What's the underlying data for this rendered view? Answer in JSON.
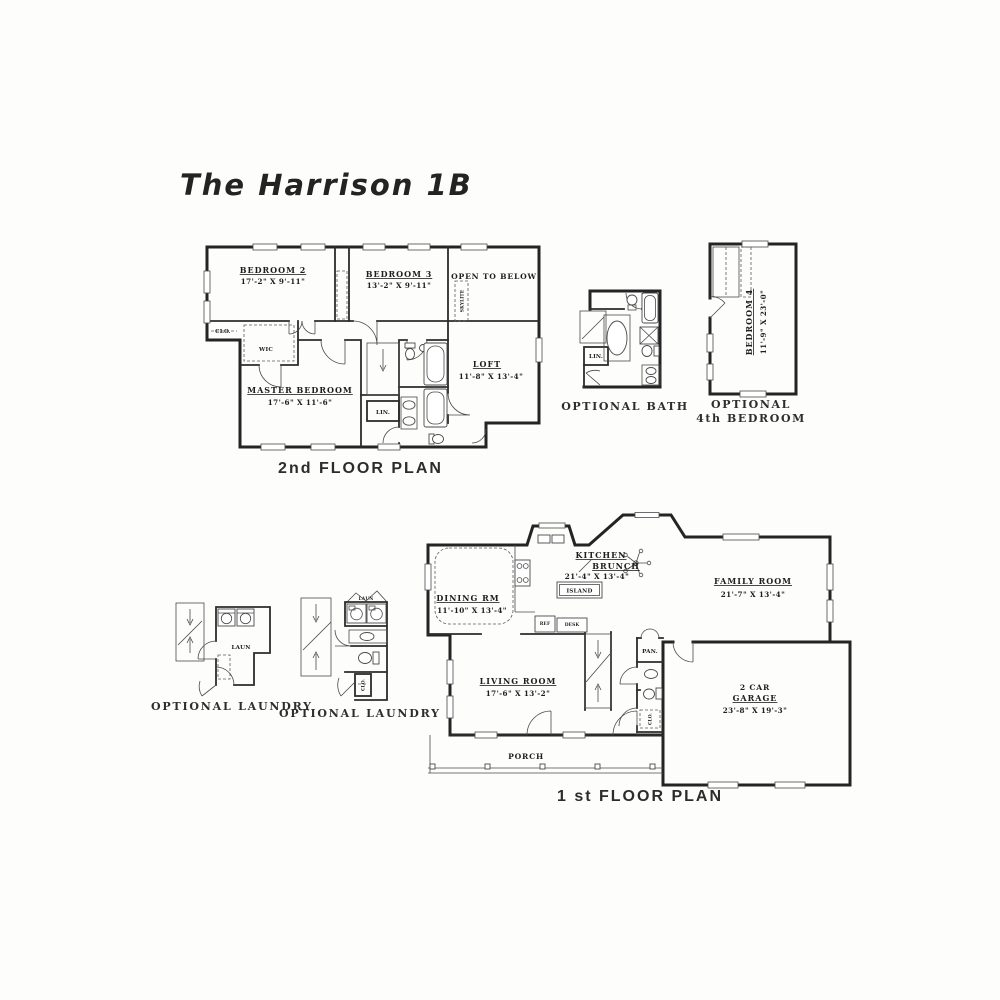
{
  "page": {
    "bg": "#fdfdfc",
    "ink": "#2c2c2c"
  },
  "title": "The Harrison 1B",
  "floor2": {
    "caption": "2nd FLOOR PLAN",
    "bedroom2_name": "BEDROOM 2",
    "bedroom2_dims": "17'-2\" X 9'-11\"",
    "bedroom3_name": "BEDROOM 3",
    "bedroom3_dims": "13'-2\" X 9'-11\"",
    "open_to_below": "OPEN TO BELOW",
    "skylite": "SKYLITE",
    "master_name": "MASTER BEDROOM",
    "master_dims": "17'-6\" X 11'-6\"",
    "loft_name": "LOFT",
    "loft_dims": "11'-8\" X 13'-4\"",
    "wic": "WIC",
    "clo": "CLO.",
    "lin": "LIN."
  },
  "optional_bath": {
    "caption": "OPTIONAL BATH",
    "lin": "LIN."
  },
  "optional_bedroom4": {
    "caption_line1": "OPTIONAL",
    "caption_line2": "4th BEDROOM",
    "name": "BEDROOM 4",
    "dims": "11'-9\" X 23'-0\""
  },
  "floor1": {
    "caption": "1 st FLOOR PLAN",
    "dining_name": "DINING RM",
    "dining_dims": "11'-10\" X 13'-4\"",
    "kitchen_name1": "KITCHEN",
    "kitchen_name2": "BRUNCH",
    "kitchen_dims": "21'-4\" X 13'-4\"",
    "island": "ISLAND",
    "family_name": "FAMILY ROOM",
    "family_dims": "21'-7\" X 13'-4\"",
    "living_name": "LIVING ROOM",
    "living_dims": "17'-6\" X 13'-2\"",
    "garage_name1": "2 CAR",
    "garage_name2": "GARAGE",
    "garage_dims": "23'-8\" X 19'-3\"",
    "porch": "PORCH",
    "pan": "PAN.",
    "clo": "CLO.",
    "ref": "REF",
    "desk": "DESK"
  },
  "optional_laundry_left": {
    "caption": "OPTIONAL LAUNDRY",
    "laun": "LAUN"
  },
  "optional_laundry_right": {
    "caption": "OPTIONAL LAUNDRY",
    "laun": "LAUN",
    "clo": "CLO."
  }
}
